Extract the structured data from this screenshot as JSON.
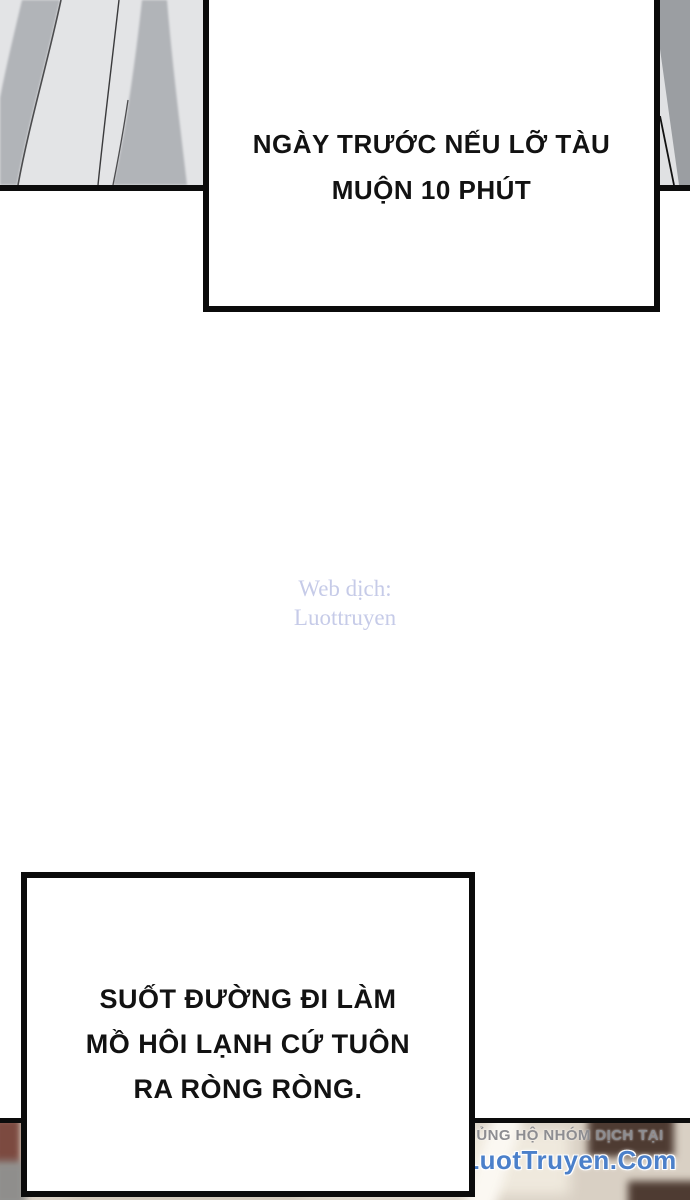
{
  "bubbles": {
    "top": {
      "lines": [
        "NGÀY TRƯỚC NẾU LỠ TÀU",
        "MUỘN 10 PHÚT"
      ]
    },
    "bottom": {
      "lines": [
        "SUỐT ĐƯỜNG ĐI LÀM",
        "MỒ HÔI LẠNH CỨ TUÔN",
        "RA RÒNG RÒNG."
      ]
    }
  },
  "watermark": {
    "lines": [
      "Web dịch:",
      "Luottruyen"
    ],
    "color": "#c6cbe8"
  },
  "credit": {
    "support_text": "ỦNG HỘ NHÓM DỊCH TẠI",
    "site_name": "LuotTruyen.Com",
    "support_color": "#8d8d91",
    "site_color": "#4b80ca"
  },
  "art": {
    "panel_bg": "#e3e4e6",
    "fold_gray": "#b1b4b8",
    "fragment_gray": "#9b9ea2",
    "ink": "#0c0c0c"
  }
}
